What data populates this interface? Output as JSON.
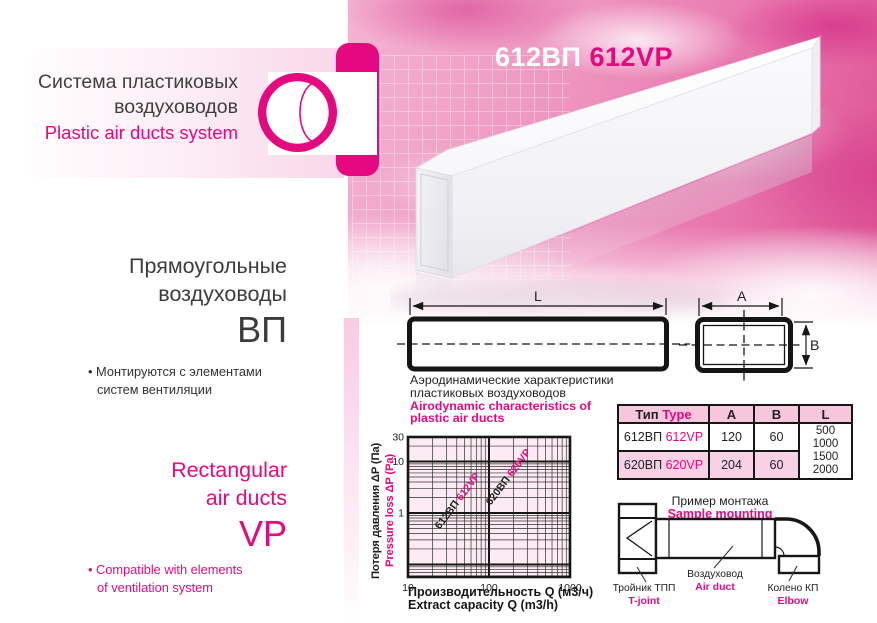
{
  "colors": {
    "accent": "#e4097f"
  },
  "logo": {
    "ru1": "Система пластиковых",
    "ru2": "воздуховодов",
    "en": "Plastic air ducts system"
  },
  "product_title": {
    "ru": "612ВП",
    "en": "612VP"
  },
  "left_panel": {
    "bullet_char": "•",
    "ru_title1": "Прямоугольные",
    "ru_title2": "воздуховоды",
    "ru_code": "ВП",
    "ru_bullet1": "Монтируются с элементами",
    "ru_bullet2": "систем вентиляции",
    "en_title1": "Rectangular",
    "en_title2": "air ducts",
    "en_code": "VP",
    "en_bullet1": "Compatible with elements",
    "en_bullet2": "of ventilation system"
  },
  "drawing": {
    "l": "L",
    "a": "A",
    "b": "B"
  },
  "chart_data": {
    "type": "line",
    "title_ru1": "Аэродинамические характеристики",
    "title_ru2": "пластиковых воздуховодов",
    "title_en1": "Airodynamic characteristics of",
    "title_en2": "plastic air ducts",
    "xlabel_ru": "Производительность Q (м3/ч)",
    "xlabel_en": "Extract capacity Q (m3/h)",
    "ylabel_ru": "Потеря давления ΔP (Па)",
    "ylabel_en": "Pressure loss ΔP (Pa)",
    "x_scale": "log",
    "y_scale": "log",
    "xlim": [
      10,
      1000
    ],
    "ylim": [
      0.057,
      30
    ],
    "x_ticks": [
      "10",
      "100",
      "1000"
    ],
    "y_ticks": [
      {
        "v": 30,
        "label": "30"
      },
      {
        "v": 10,
        "label": "10"
      },
      {
        "v": 1,
        "label": "1"
      }
    ],
    "grid": "log-log with minor gridlines",
    "series": [
      {
        "name_ru": "612ВП",
        "name_en": "612VP",
        "points": [
          [
            10.7,
            0.057
          ],
          [
            45,
            1
          ],
          [
            142,
            10
          ],
          [
            246,
            30
          ]
        ]
      },
      {
        "name_ru": "620ВП",
        "name_en": "620VP",
        "points": [
          [
            16.7,
            0.057
          ],
          [
            70,
            1
          ],
          [
            221,
            10
          ],
          [
            383,
            30
          ]
        ]
      }
    ]
  },
  "table": {
    "header": {
      "type_ru": "Тип",
      "type_en": "Type",
      "a": "A",
      "b": "B",
      "l": "L"
    },
    "rows": [
      {
        "type_ru": "612ВП",
        "type_en": "612VP",
        "a": "120",
        "b": "60"
      },
      {
        "type_ru": "620ВП",
        "type_en": "620VP",
        "a": "204",
        "b": "60"
      }
    ],
    "length_options": [
      "500",
      "1000",
      "1500",
      "2000"
    ]
  },
  "mounting": {
    "title_ru": "Пример монтажа",
    "title_en": "Sample mounting",
    "tjoint_ru": "Тройник ТПП",
    "tjoint_en": "T-joint",
    "duct_ru": "Воздуховод",
    "duct_en": "Air duct",
    "elbow_ru": "Колено КП",
    "elbow_en": "Elbow"
  }
}
